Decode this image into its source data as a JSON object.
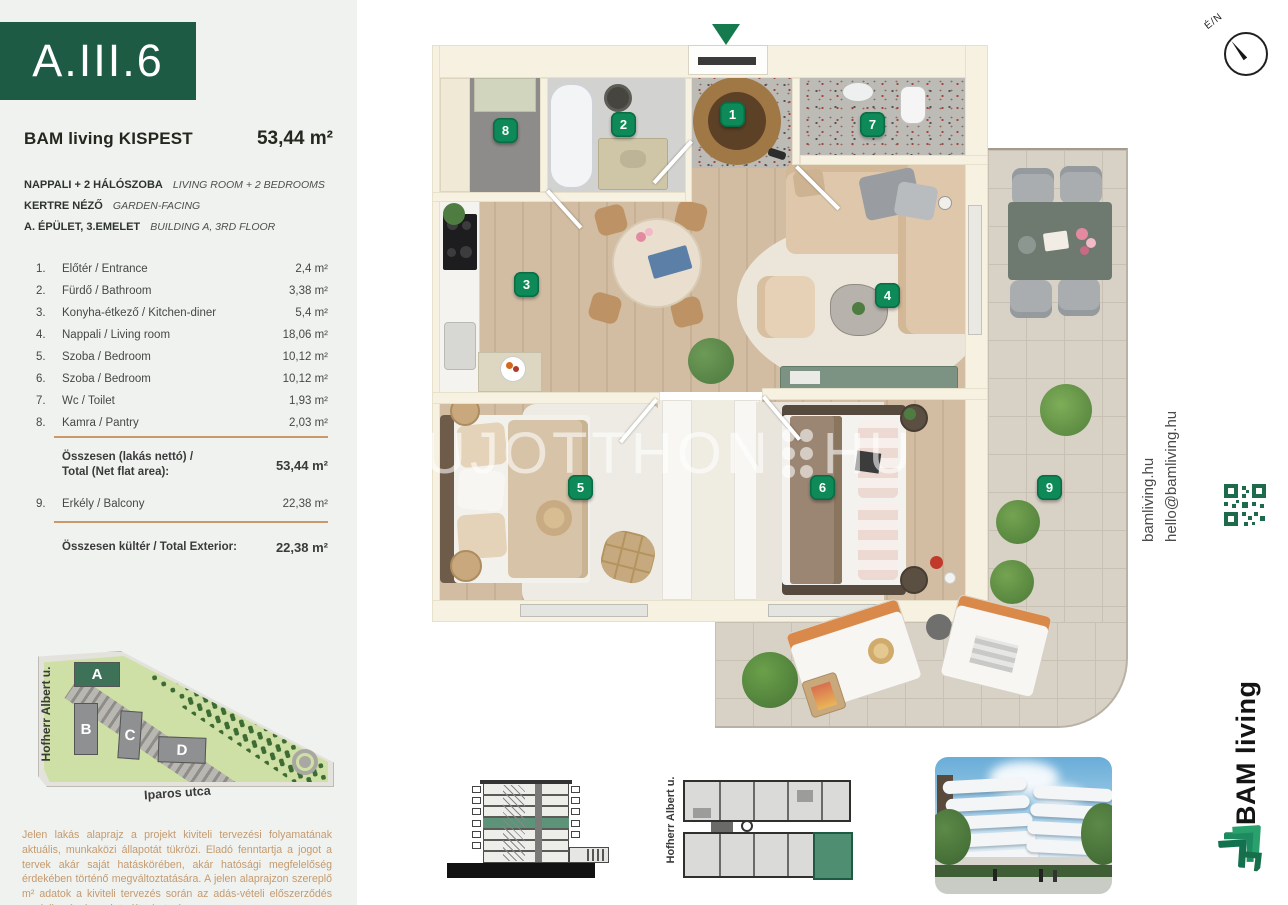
{
  "unit": {
    "code": "A.III.6",
    "project": "BAM living KISPEST",
    "total_area": "53,44 m²",
    "features": [
      {
        "hu": "NAPPALI + 2 HÁLÓSZOBA",
        "en": "LIVING ROOM + 2 BEDROOMS"
      },
      {
        "hu": "KERTRE NÉZŐ",
        "en": "GARDEN-FACING"
      },
      {
        "hu": "A. ÉPÜLET, 3.EMELET",
        "en": "BUILDING A, 3RD FLOOR"
      }
    ]
  },
  "room_table": {
    "rows": [
      {
        "num": "1.",
        "name": "Előtér / Entrance",
        "area": "2,4 m²"
      },
      {
        "num": "2.",
        "name": "Fürdő / Bathroom",
        "area": "3,38 m²"
      },
      {
        "num": "3.",
        "name": "Konyha-étkező / Kitchen-diner",
        "area": "5,4 m²"
      },
      {
        "num": "4.",
        "name": "Nappali / Living room",
        "area": "18,06 m²"
      },
      {
        "num": "5.",
        "name": "Szoba / Bedroom",
        "area": "10,12 m²"
      },
      {
        "num": "6.",
        "name": "Szoba / Bedroom",
        "area": "10,12 m²"
      },
      {
        "num": "7.",
        "name": "Wc / Toilet",
        "area": "1,93 m²"
      },
      {
        "num": "8.",
        "name": "Kamra / Pantry",
        "area": "2,03 m²"
      }
    ],
    "net_total": {
      "label_line1": "Összesen (lakás nettó) /",
      "label_line2": "Total (Net flat area):",
      "value": "53,44 m²"
    },
    "balcony_row": {
      "num": "9.",
      "name": "Erkély / Balcony",
      "area": "22,38 m²"
    },
    "exterior_total": {
      "label": "Összesen kültér / Total Exterior:",
      "value": "22,38 m²"
    }
  },
  "site_plan": {
    "street_left": "Hofherr Albert u.",
    "street_bottom": "Iparos utca",
    "buildings": [
      "A",
      "B",
      "C",
      "D"
    ]
  },
  "floor_plan": {
    "badges": [
      "1",
      "2",
      "3",
      "4",
      "5",
      "6",
      "7",
      "8",
      "9"
    ],
    "watermark_name": "UJOTTHON",
    "watermark_tld": "HU",
    "compass_label": "É/N"
  },
  "key_plan": {
    "street_label": "Hofherr Albert u."
  },
  "contact": {
    "website": "bamliving.hu",
    "email": "hello@bamliving.hu",
    "brand": "BAM living"
  },
  "disclaimer": "Jelen lakás alaprajz a projekt kiviteli tervezési folyamatának aktuális, munkaközi állapotát tükrözi. Eladó fenntartja a jogot a tervek akár saját hatáskörében, akár hatósági megfelelőség érdekében történő megváltoztatására. A jelen alaprajzon szereplő m² adatok a kiviteli tervezés során az adás-vételi előszerződés rendelkezései szerint változhatnak.",
  "colors": {
    "brand_green": "#1e5b45",
    "badge_green": "#0d8a57",
    "accent_orange": "#c9996b"
  }
}
